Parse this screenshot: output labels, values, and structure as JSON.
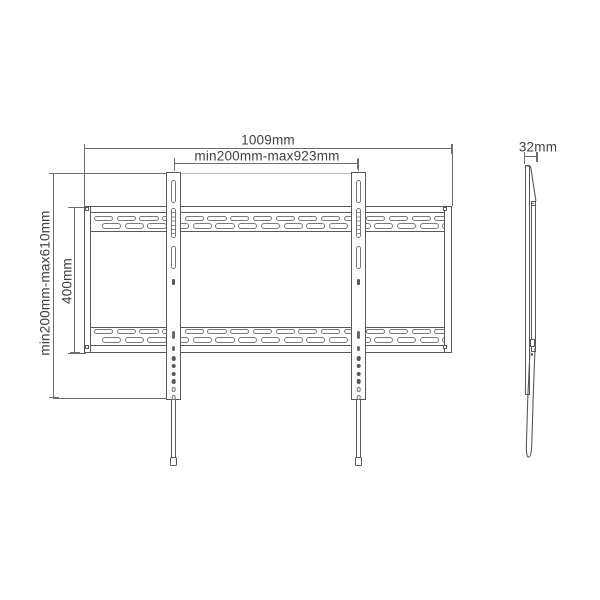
{
  "dimensions": {
    "overall_width": "1009mm",
    "mount_width_range": "min200mm-max923mm",
    "mount_height_range": "min200mm-max610mm",
    "plate_height": "400mm",
    "profile_depth": "32mm"
  },
  "front_view": {
    "slots_per_row": 16,
    "arm_filled_holes": 4,
    "arm_open_holes": 2
  },
  "colors": {
    "line": "#58595b",
    "dim_line": "#6d6e71",
    "text": "#414042",
    "background": "#ffffff"
  }
}
